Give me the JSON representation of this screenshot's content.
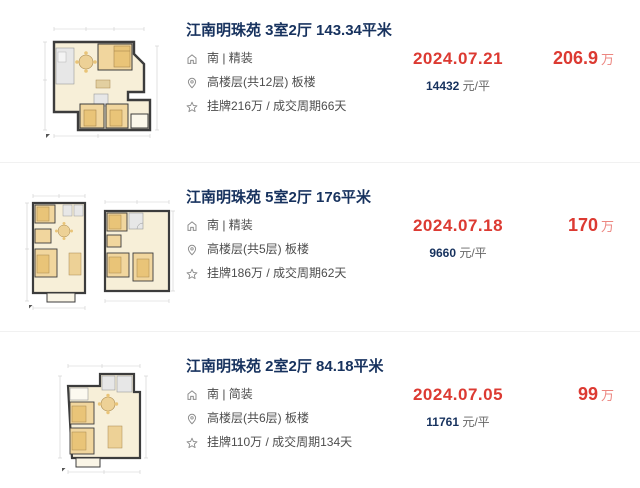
{
  "colors": {
    "title_navy": "#17325e",
    "deal_red": "#dc3a32",
    "price_unit_red": "#ec8680",
    "detail_gray": "#4d4d4d",
    "divider": "#f1f1f1",
    "plan_wall": "#3c3c3c",
    "plan_cream": "#f7efd8",
    "plan_tan": "#f1d69e",
    "plan_gray": "#e7e7e7"
  },
  "icons": [
    {
      "name": "home-icon"
    },
    {
      "name": "location-pin-icon"
    },
    {
      "name": "star-icon"
    }
  ],
  "listings": [
    {
      "title": "江南明珠苑 3室2厅 143.34平米",
      "orientation": "南 | 精装",
      "floor": "高楼层(共12层) 板楼",
      "listing_cycle": "挂牌216万 / 成交周期66天",
      "deal_date": "2024.07.21",
      "unit_price": "14432",
      "unit_price_suffix": " 元/平",
      "total_price": "206.9",
      "total_price_unit": "万"
    },
    {
      "title": "江南明珠苑 5室2厅 176平米",
      "orientation": "南 | 精装",
      "floor": "高楼层(共5层) 板楼",
      "listing_cycle": "挂牌186万 / 成交周期62天",
      "deal_date": "2024.07.18",
      "unit_price": "9660",
      "unit_price_suffix": " 元/平",
      "total_price": "170",
      "total_price_unit": "万"
    },
    {
      "title": "江南明珠苑 2室2厅 84.18平米",
      "orientation": "南 | 简装",
      "floor": "高楼层(共6层) 板楼",
      "listing_cycle": "挂牌110万 / 成交周期134天",
      "deal_date": "2024.07.05",
      "unit_price": "11761",
      "unit_price_suffix": " 元/平",
      "total_price": "99",
      "total_price_unit": "万"
    }
  ]
}
